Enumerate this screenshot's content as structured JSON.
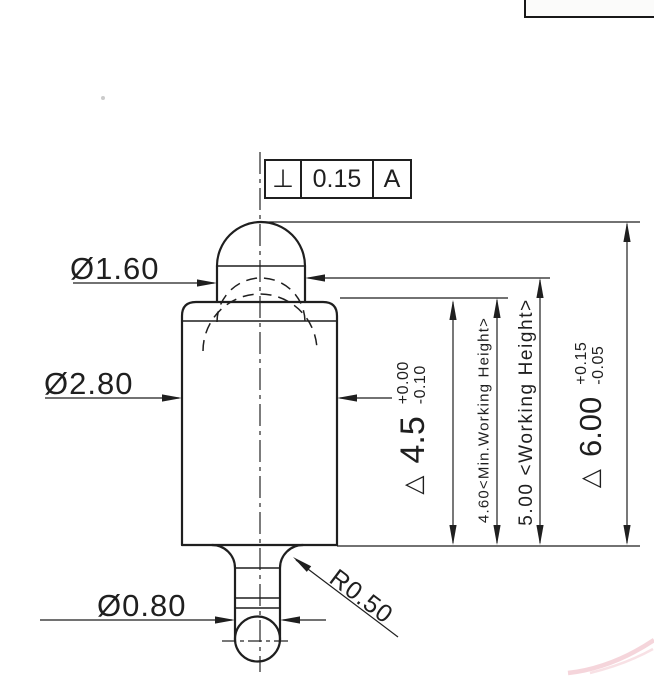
{
  "drawing": {
    "type": "spring-loaded pogo pin, dimensioned side view",
    "tolerance_frame": {
      "symbol": "⊥",
      "value": "0.15",
      "datum": "A"
    },
    "dims": {
      "dia_plunger": {
        "label": "Ø1.60"
      },
      "dia_body": {
        "label": "Ø2.80"
      },
      "dia_tail": {
        "label": "Ø0.80"
      },
      "radius": {
        "label": "R0.50"
      },
      "stroke": {
        "flag": "△",
        "value": "4.5",
        "tol_plus": "+0.00",
        "tol_minus": "-0.10"
      },
      "min_working_height": {
        "label": "4.60<Min.Working Height>"
      },
      "working_height": {
        "label": "5.00 <Working Height>"
      },
      "overall_height": {
        "flag": "△",
        "value": "6.00",
        "tol_plus": "+0.15",
        "tol_minus": "-0.05"
      }
    },
    "colors": {
      "ink": "#1f1f1f",
      "paper": "#ffffff",
      "scan_smudge_pink": "#edb3be"
    }
  }
}
